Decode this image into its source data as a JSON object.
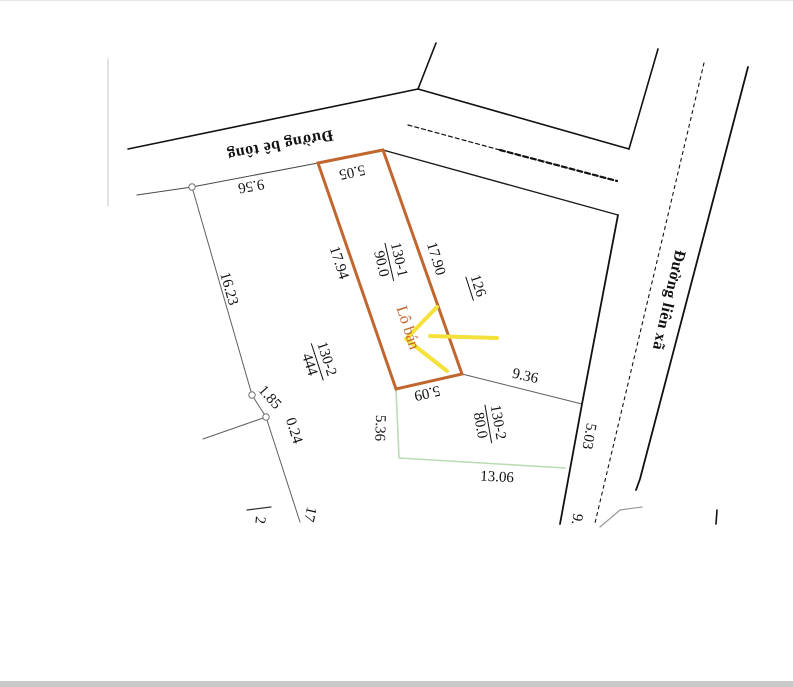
{
  "document": {
    "type": "cadastral-plot-sketch",
    "background": "#ffffff",
    "bottom_bar_color": "#c9c9c9"
  },
  "map": {
    "highlight_plot": {
      "plot_id": "130-1",
      "area": "90.0",
      "sale_label": "Lô bán",
      "outline_color": "#c0662e",
      "polygon": [
        [
          318,
          162
        ],
        [
          383,
          149
        ],
        [
          462,
          373
        ],
        [
          396,
          388
        ]
      ]
    },
    "arrow": {
      "color": "#f4e23b",
      "width": 4,
      "head": [
        [
          437,
          306
        ],
        [
          406,
          338
        ],
        [
          447,
          370
        ]
      ],
      "tail": [
        [
          430,
          335
        ],
        [
          497,
          337
        ]
      ]
    },
    "lines": [
      {
        "name": "sheet-edge-left",
        "pts": [
          [
            108,
            58
          ],
          [
            108,
            205
          ]
        ],
        "color": "#c4c4c4",
        "w": 1
      },
      {
        "name": "road-top-lower-edge-left",
        "pts": [
          [
            137,
            194
          ],
          [
            192,
            186
          ],
          [
            318,
            162
          ]
        ],
        "color": "#4a4a4a",
        "w": 1.1
      },
      {
        "name": "boundary-16-23",
        "pts": [
          [
            192,
            186
          ],
          [
            252,
            394
          ]
        ],
        "color": "#5f5f5f",
        "w": 1
      },
      {
        "name": "boundary-1-85",
        "pts": [
          [
            252,
            394
          ],
          [
            266,
            416
          ]
        ],
        "color": "#5f5f5f",
        "w": 1
      },
      {
        "name": "boundary-west-stub",
        "pts": [
          [
            266,
            416
          ],
          [
            203,
            438
          ]
        ],
        "color": "#5f5f5f",
        "w": 1
      },
      {
        "name": "boundary-south",
        "pts": [
          [
            266,
            416
          ],
          [
            300,
            521
          ]
        ],
        "color": "#5f5f5f",
        "w": 1
      },
      {
        "name": "boundary-9-36",
        "pts": [
          [
            462,
            373
          ],
          [
            582,
            403
          ]
        ],
        "color": "#5f5f5f",
        "w": 1
      },
      {
        "name": "label-2-underline",
        "pts": [
          [
            247,
            509
          ],
          [
            271,
            506
          ]
        ],
        "color": "#333333",
        "w": 1.2
      },
      {
        "name": "road-top-upper-edge",
        "pts": [
          [
            128,
            148
          ],
          [
            418,
            88
          ]
        ],
        "color": "#111111",
        "w": 1.6
      },
      {
        "name": "boundary-north-branch",
        "pts": [
          [
            418,
            88
          ],
          [
            436,
            42
          ]
        ],
        "color": "#111111",
        "w": 1.6
      },
      {
        "name": "road-top-upper-edge-right",
        "pts": [
          [
            418,
            88
          ],
          [
            629,
            148
          ]
        ],
        "color": "#111111",
        "w": 1.6
      },
      {
        "name": "road-right-left-edge-upper",
        "pts": [
          [
            658,
            48
          ],
          [
            629,
            148
          ]
        ],
        "color": "#111111",
        "w": 1.6
      },
      {
        "name": "road-top-lower-edge-right",
        "pts": [
          [
            383,
            149
          ],
          [
            618,
            214
          ]
        ],
        "color": "#1a1a1a",
        "w": 1.4
      },
      {
        "name": "road-right-left-edge-lower",
        "pts": [
          [
            618,
            214
          ],
          [
            582,
            403
          ],
          [
            560,
            523
          ]
        ],
        "color": "#111111",
        "w": 1.8
      },
      {
        "name": "road-right-right-edge",
        "pts": [
          [
            748,
            66
          ],
          [
            640,
            478
          ],
          [
            636,
            489
          ]
        ],
        "color": "#111111",
        "w": 1.8
      },
      {
        "name": "road-right-centerline",
        "pts": [
          [
            704,
            62
          ],
          [
            595,
            522
          ]
        ],
        "color": "#111111",
        "w": 1.1,
        "dash": "3 4"
      },
      {
        "name": "road-top-centerline-a",
        "pts": [
          [
            408,
            124
          ],
          [
            500,
            149
          ]
        ],
        "color": "#111111",
        "w": 1.2,
        "dash": "4 3"
      },
      {
        "name": "road-top-centerline-b",
        "pts": [
          [
            500,
            149
          ],
          [
            617,
            180
          ]
        ],
        "color": "#111111",
        "w": 2.2,
        "dash": "5 3"
      },
      {
        "name": "boundary-5-36-green",
        "pts": [
          [
            396,
            388
          ],
          [
            399,
            457
          ],
          [
            565,
            467
          ]
        ],
        "color": "#b9dcb2",
        "w": 1.6
      },
      {
        "name": "road-curve-bottom",
        "pts": [
          [
            600,
            526
          ],
          [
            620,
            509
          ],
          [
            642,
            506
          ]
        ],
        "color": "#999999",
        "w": 1.2
      },
      {
        "name": "tick-mark",
        "pts": [
          [
            717,
            509
          ],
          [
            716,
            523
          ]
        ],
        "color": "#111111",
        "w": 1.6
      }
    ],
    "survey_points": [
      [
        192,
        186
      ],
      [
        252,
        394
      ],
      [
        266,
        416
      ]
    ],
    "labels": [
      {
        "id": "road-top-name",
        "text": "Đường bê tông",
        "x": 280,
        "y": 143,
        "rot": 169,
        "fz": 16,
        "road": true
      },
      {
        "id": "road-right-name",
        "text": "Đường liên xã",
        "x": 668,
        "y": 299,
        "rot": 103,
        "fz": 16,
        "road": true
      },
      {
        "id": "dim-9-56",
        "text": "9.56",
        "x": 251,
        "y": 184,
        "rot": 170
      },
      {
        "id": "dim-5-05",
        "text": "5.05",
        "x": 352,
        "y": 170,
        "rot": 168
      },
      {
        "id": "dim-17-94",
        "text": "17.94",
        "x": 338,
        "y": 262,
        "rot": 72
      },
      {
        "id": "dim-17-90",
        "text": "17.90",
        "x": 435,
        "y": 258,
        "rot": 73
      },
      {
        "id": "dim-16-23",
        "text": "16.23",
        "x": 228,
        "y": 288,
        "rot": 74
      },
      {
        "id": "plot-130-1-label",
        "num": "130-1",
        "den": "90.0",
        "x": 389,
        "y": 261,
        "rot": 77
      },
      {
        "id": "plot-126-label",
        "text": "126",
        "x": 477,
        "y": 285,
        "rot": 72,
        "underline": true
      },
      {
        "id": "sale-plot-label",
        "text": "Lô bán",
        "x": 407,
        "y": 327,
        "rot": 72,
        "fz": 16,
        "color": "#c0662e"
      },
      {
        "id": "plot-130-2-444-label",
        "num": "130-2",
        "den": "444",
        "x": 317,
        "y": 361,
        "rot": 72
      },
      {
        "id": "dim-5-09",
        "text": "5.09",
        "x": 427,
        "y": 391,
        "rot": 167
      },
      {
        "id": "dim-5-36",
        "text": "5.36",
        "x": 379,
        "y": 427,
        "rot": 92
      },
      {
        "id": "plot-130-2-80-label",
        "num": "130-2",
        "den": "80.0",
        "x": 488,
        "y": 423,
        "rot": 80
      },
      {
        "id": "dim-9-36",
        "text": "9.36",
        "x": 525,
        "y": 376,
        "rot": 13
      },
      {
        "id": "dim-13-06",
        "text": "13.06",
        "x": 497,
        "y": 477,
        "rot": 3
      },
      {
        "id": "dim-5-03",
        "text": "5.03",
        "x": 588,
        "y": 435,
        "rot": 100
      },
      {
        "id": "dim-9-partial",
        "text": "9.",
        "x": 576,
        "y": 518,
        "rot": 100
      },
      {
        "id": "dim-1-85",
        "text": "1.85",
        "x": 269,
        "y": 397,
        "rot": 48
      },
      {
        "id": "dim-0-24",
        "text": "0.24",
        "x": 293,
        "y": 430,
        "rot": 72
      },
      {
        "id": "dim-17-partial",
        "text": "17",
        "x": 309,
        "y": 513,
        "rot": 103
      },
      {
        "id": "dim-2-partial",
        "text": "2",
        "x": 259,
        "y": 519,
        "rot": 95
      }
    ]
  }
}
